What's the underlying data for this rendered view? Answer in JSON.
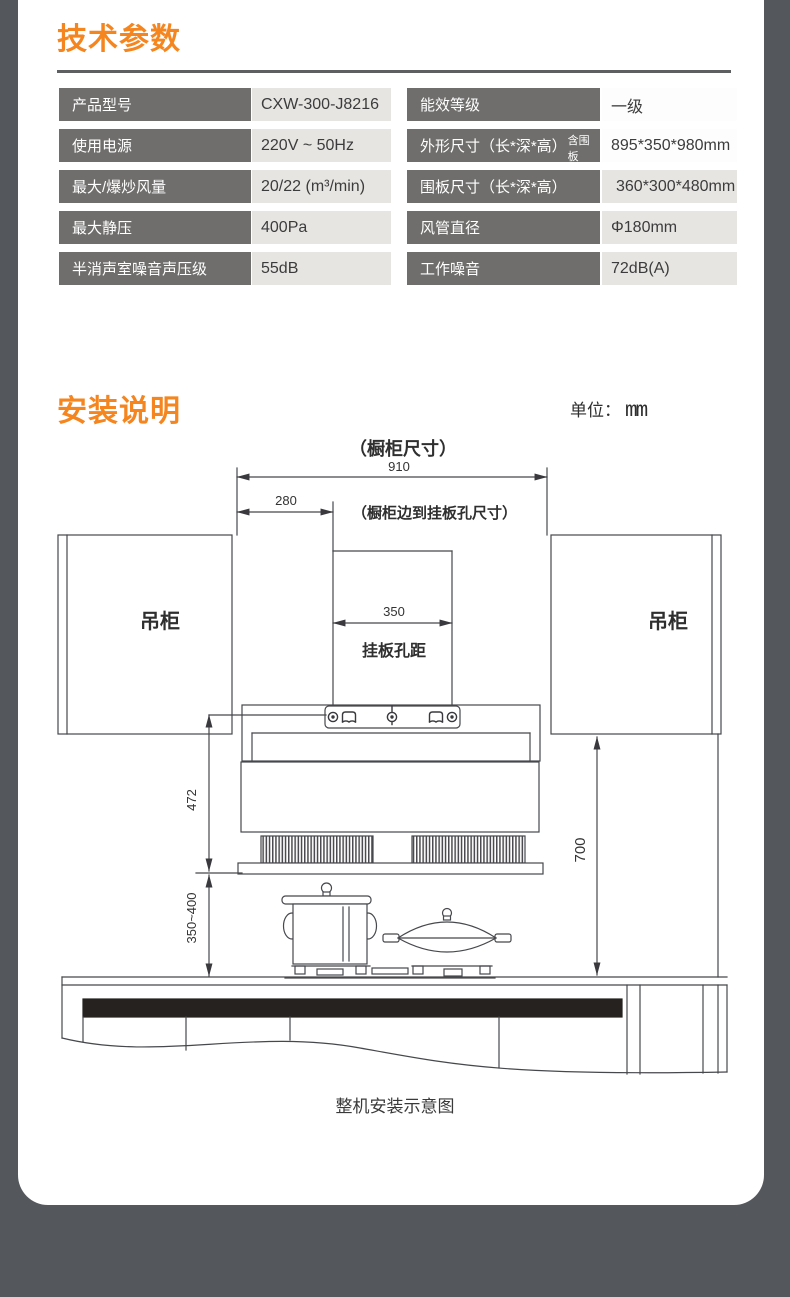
{
  "page": {
    "bg": "#54585c",
    "card_bg": "#ffffff",
    "accent": "#f5861f"
  },
  "tech_section": {
    "title": "技术参数",
    "rows_left": [
      {
        "label": "产品型号",
        "value": "CXW-300-J8216"
      },
      {
        "label": "使用电源",
        "value": "220V ~ 50Hz"
      },
      {
        "label": "最大/爆炒风量",
        "value": "20/22 (m³/min)"
      },
      {
        "label": "最大静压",
        "value": "400Pa"
      },
      {
        "label": "半消声室噪音声压级",
        "value": "55dB"
      }
    ],
    "rows_right": [
      {
        "label": "能效等级",
        "note": "",
        "value": "一级"
      },
      {
        "label": "外形尺寸（长*深*高）",
        "note": "含围板",
        "value": "895*350*980mm"
      },
      {
        "label": "围板尺寸（长*深*高）",
        "note": "",
        "value": "360*300*480mm"
      },
      {
        "label": "风管直径",
        "note": "",
        "value": "Φ180mm"
      },
      {
        "label": "工作噪音",
        "note": "",
        "value": "72dB(A)"
      }
    ]
  },
  "install_section": {
    "title": "安装说明",
    "unit_label": "单位：",
    "unit_value": "mm",
    "caption": "整机安装示意图",
    "diagram": {
      "cabinet_dim_note": "（橱柜尺寸）",
      "dim_910": "910",
      "dim_280": "280",
      "edge_to_hole_note": "（橱柜边到挂板孔尺寸）",
      "cabinet_left": "吊柜",
      "cabinet_right": "吊柜",
      "dim_350": "350",
      "hole_pitch_label": "挂板孔距",
      "dim_472": "472",
      "dim_700": "700",
      "dim_350_400": "350~400"
    }
  }
}
